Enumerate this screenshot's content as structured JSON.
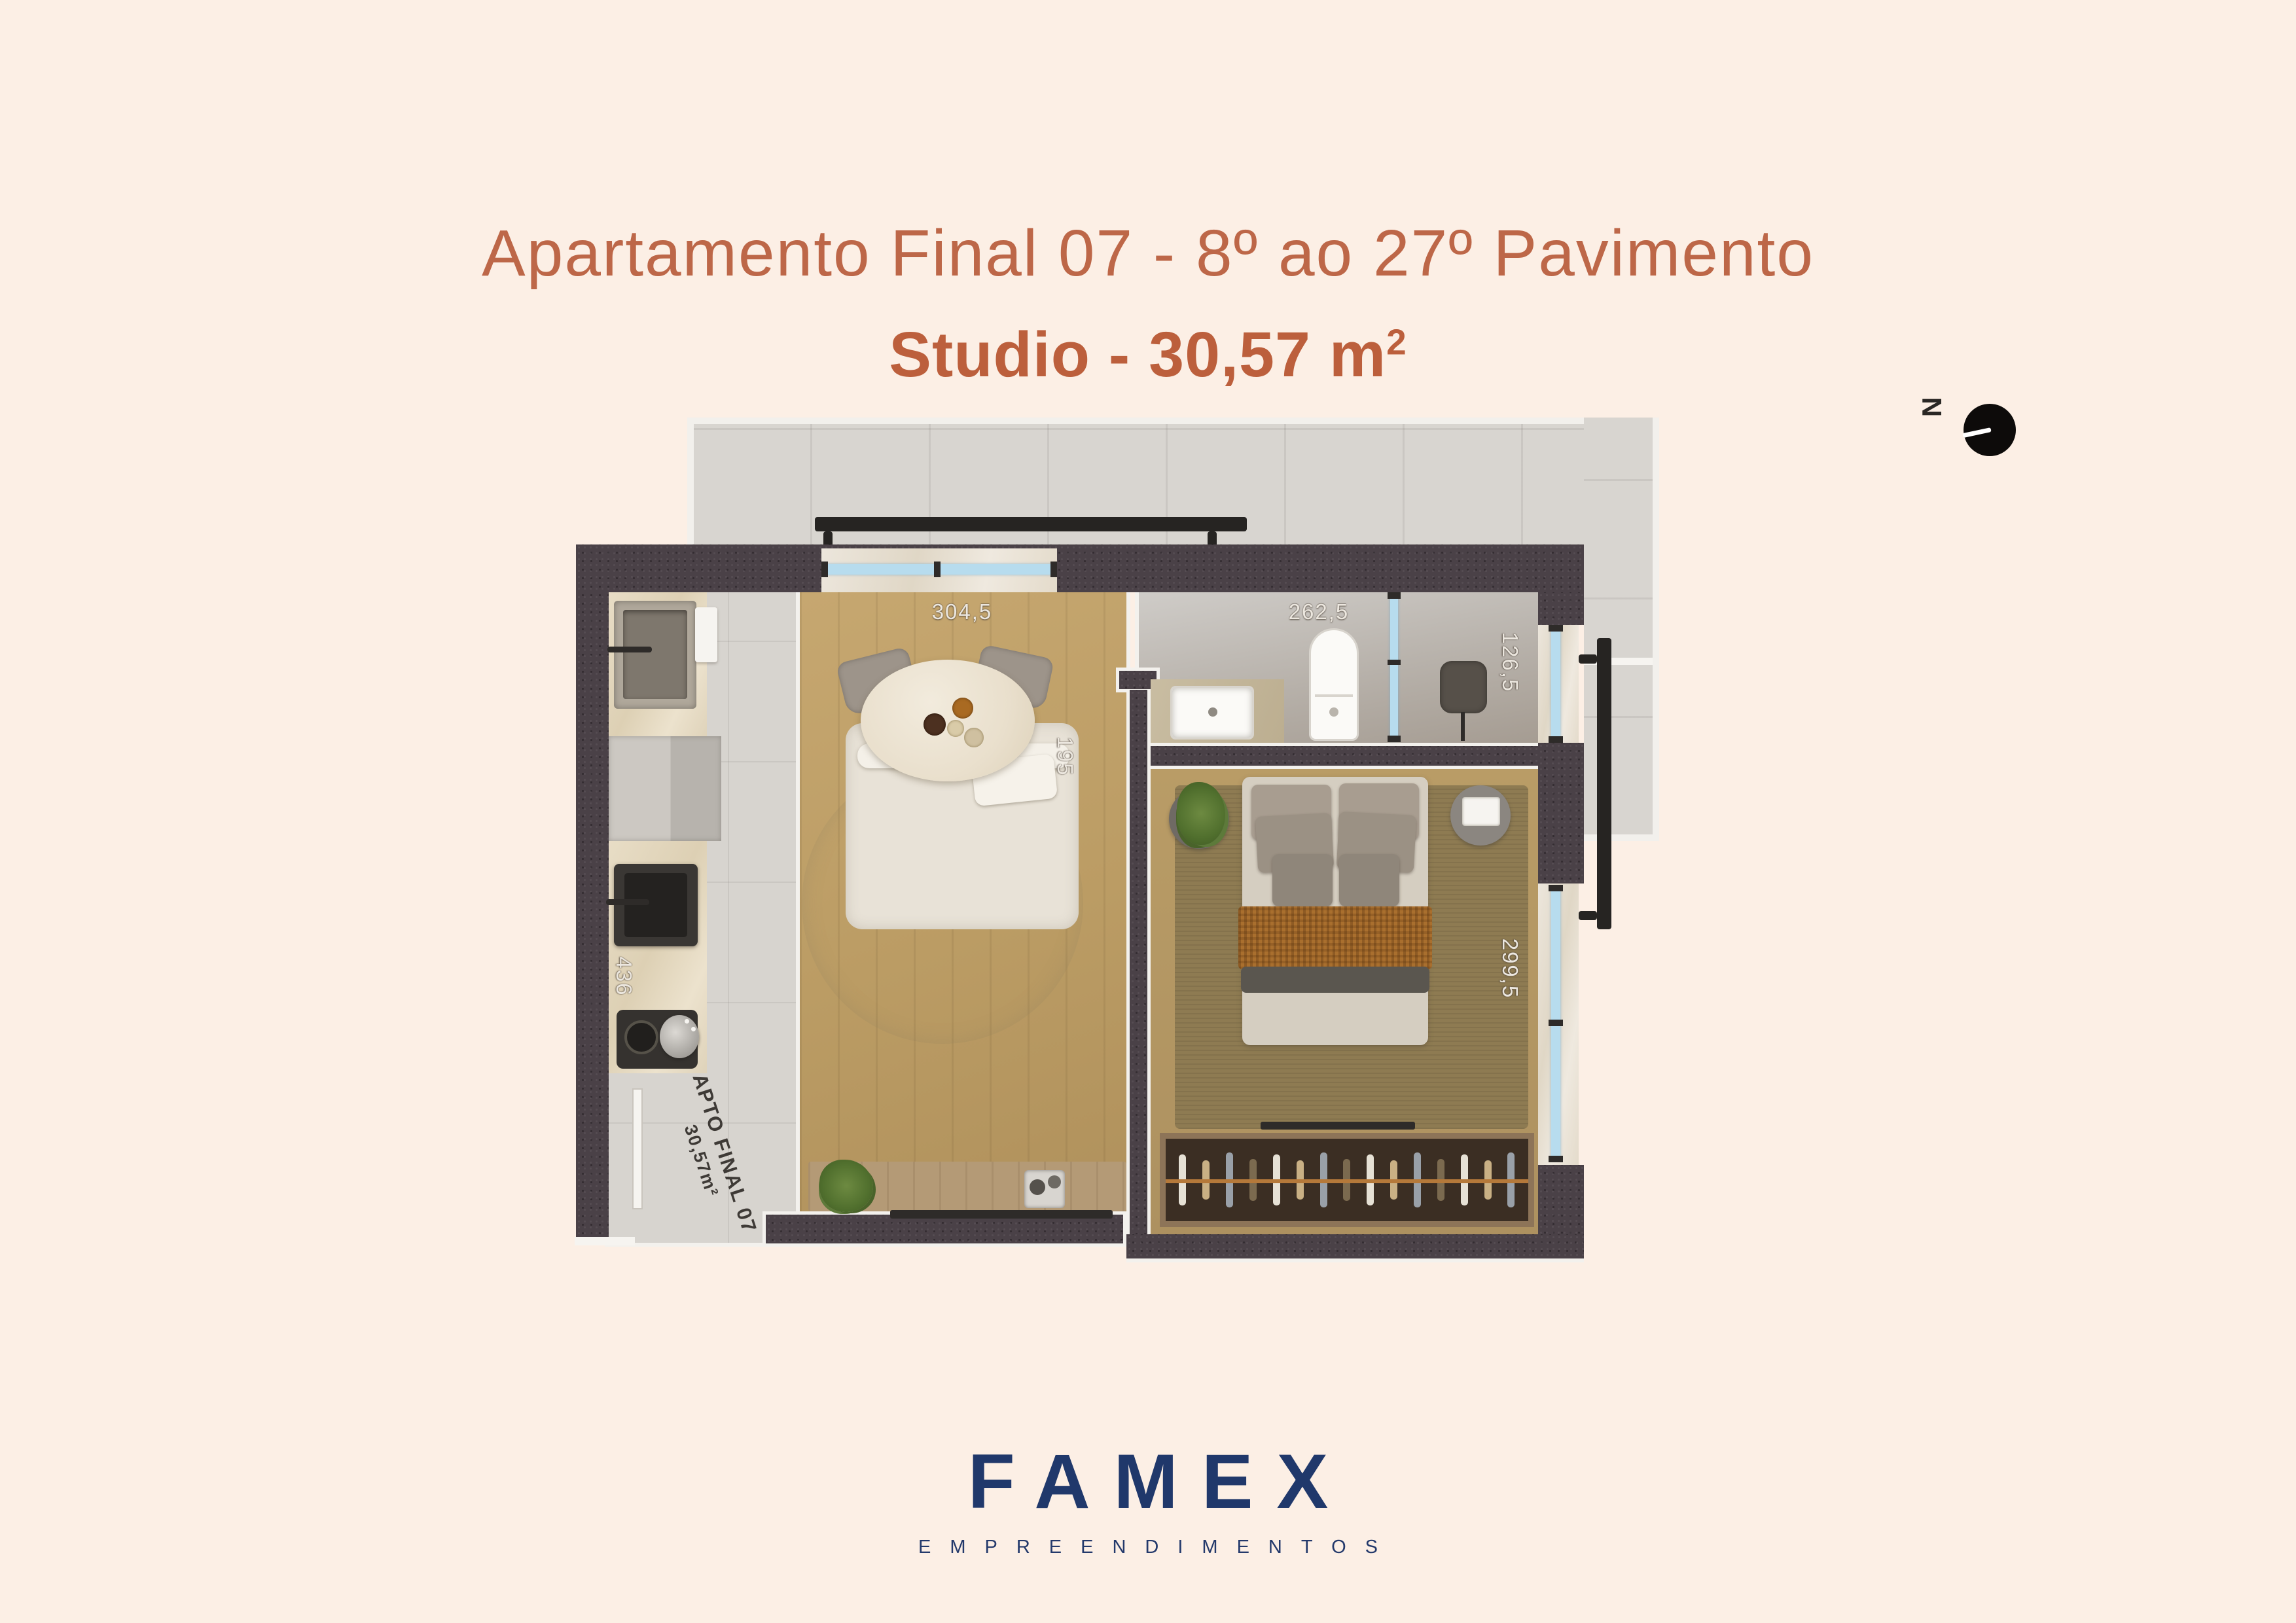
{
  "header": {
    "title": "Apartamento Final 07 - 8º ao 27º Pavimento",
    "subtitle_prefix": "Studio - 30,57 m",
    "subtitle_sup": "2"
  },
  "floorplan": {
    "unit_label_line1": "APTO FINAL 07",
    "unit_label_line2": "30,57m²",
    "dimensions": {
      "living_width": "304,5",
      "bath_width": "262,5",
      "bath_window_width": "126,5",
      "living_depth": "195",
      "kitchen_depth": "436",
      "bedroom_depth": "299,5"
    }
  },
  "compass": {
    "north_label": "N"
  },
  "footer": {
    "brand": "FAMEX",
    "tagline": "EMPREENDIMENTOS"
  },
  "colors": {
    "background": "#fcefe5",
    "accent_title": "#bd6748",
    "accent_subtitle": "#bc5f3c",
    "brand_navy": "#20386b",
    "wall_dark": "#4a4147",
    "terrace_grey": "#d8d5d0",
    "wood_floor": "#bfa06a",
    "window_glass": "#b7dcee"
  }
}
